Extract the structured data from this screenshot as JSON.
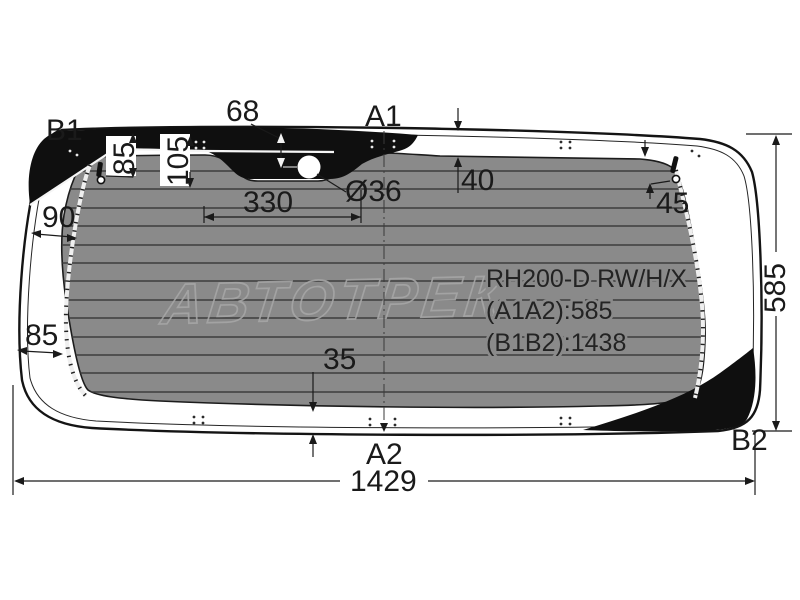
{
  "diagram": {
    "title": "Rear window glass dimension drawing",
    "part": {
      "code": "RH200-D RW/H/X",
      "a1a2": "(A1A2):585",
      "b1b2": "(B1B2):1438"
    },
    "watermark": "АВТОТРЕК",
    "labels": {
      "b1": "B1",
      "a1": "A1",
      "a2": "A2",
      "b2": "B2"
    },
    "dims": {
      "d68": "68",
      "d85_top": "85",
      "d105": "105",
      "d330": "330",
      "dia36": "Ø36",
      "d40": "40",
      "d45": "45",
      "d90": "90",
      "d85_left": "85",
      "d35": "35",
      "d585": "585",
      "d1429": "1429"
    },
    "colors": {
      "glass_tint": "#8a8a8a",
      "ceramic_band": "#0f0f0f",
      "outline": "#141414",
      "defroster_line": "#3d3d3d",
      "watermark": "#a6a6a6",
      "dimension": "#1a1a1a"
    }
  }
}
